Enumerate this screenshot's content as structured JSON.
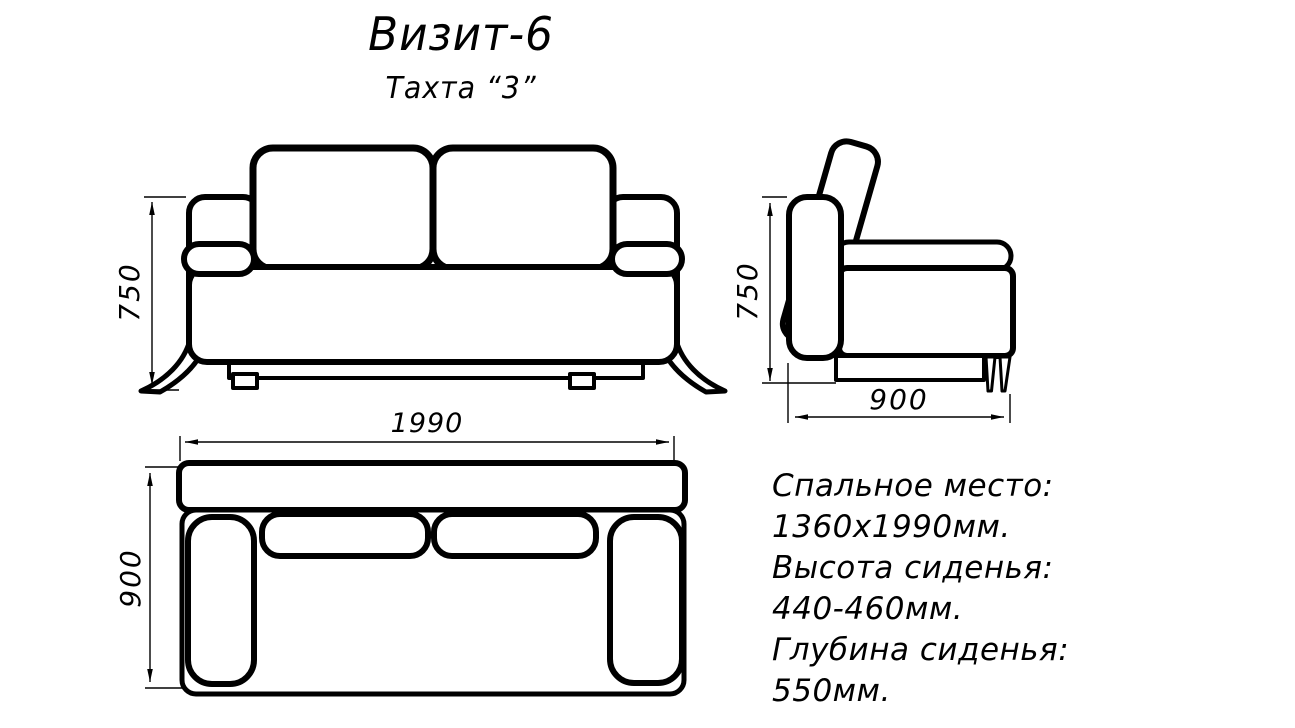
{
  "title": "Визит-6",
  "subtitle": "Тахта “3”",
  "dimensions": {
    "front_height": "750",
    "side_height": "750",
    "side_depth": "900",
    "top_width": "1990",
    "top_depth": "900"
  },
  "specs": {
    "lines": [
      "Спальное место:",
      "1360х1990мм.",
      "Высота сиденья:",
      "440-460мм.",
      "Глубина сиденья:",
      "550мм."
    ]
  },
  "colors": {
    "line": "#000000",
    "background": "#ffffff"
  }
}
